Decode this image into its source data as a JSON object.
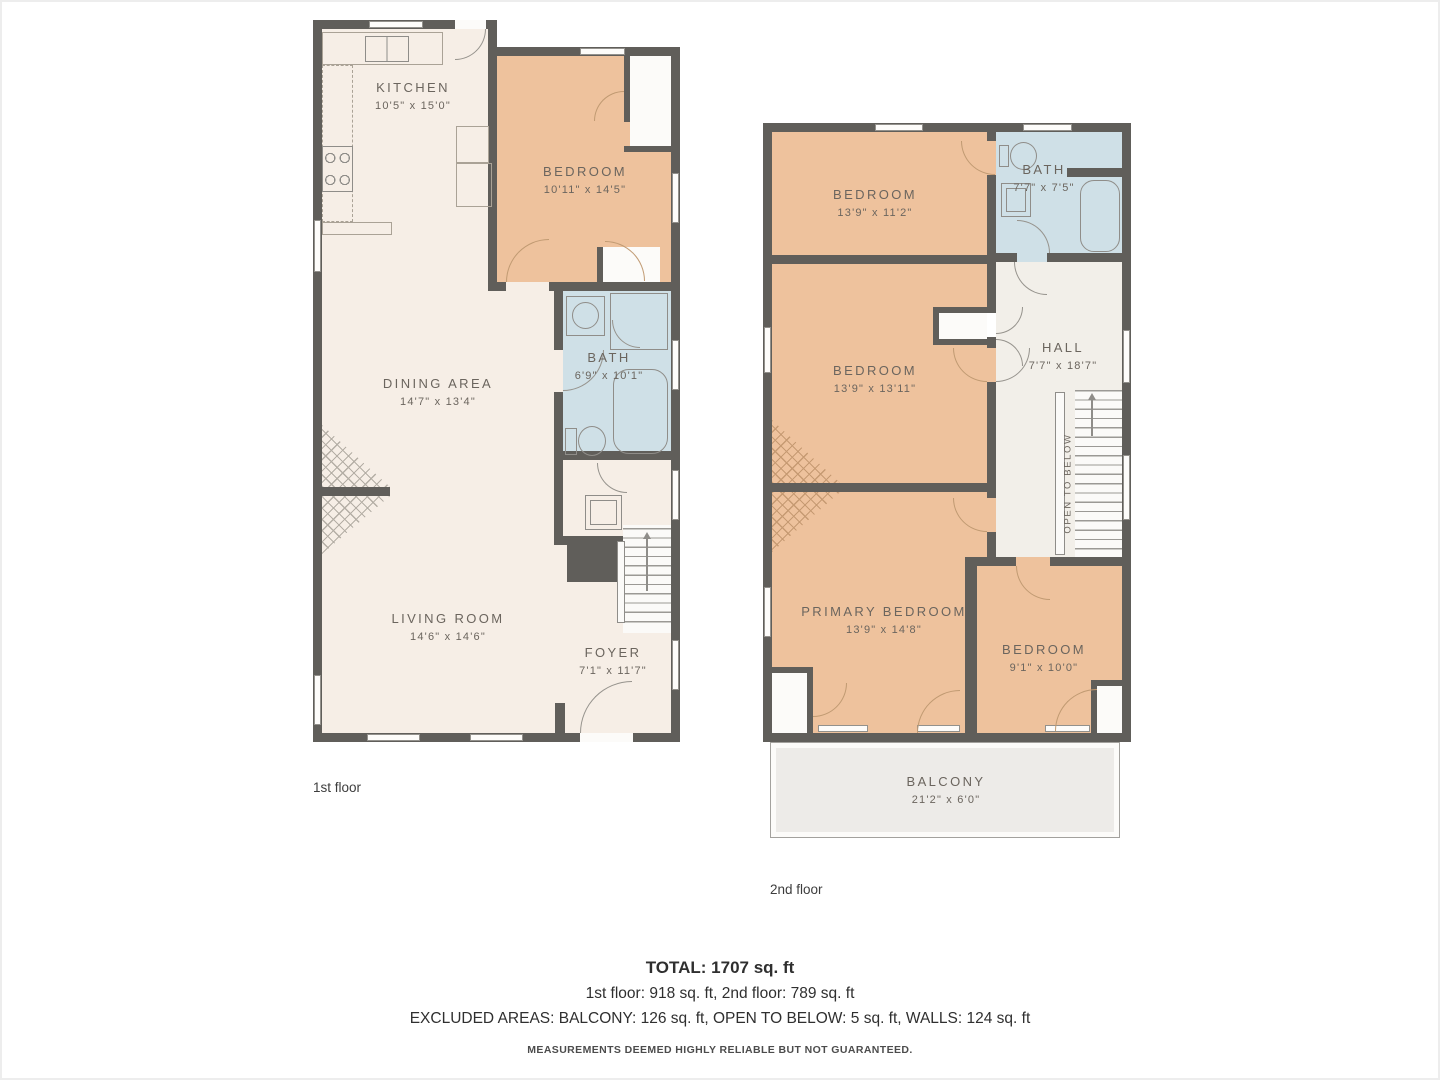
{
  "colors": {
    "wall": "#605e5a",
    "room_cream": "#f6eee6",
    "room_peach": "#eec29d",
    "bath_blue": "#cfe0e7",
    "hall_light": "#f2efe9",
    "balcony_gray": "#edebe8",
    "label_text": "#6b655e"
  },
  "floor1": {
    "caption": "1st floor",
    "kitchen": {
      "name": "KITCHEN",
      "dims": "10'5\" x 15'0\""
    },
    "bedroom": {
      "name": "BEDROOM",
      "dims": "10'11\" x 14'5\""
    },
    "bath": {
      "name": "BATH",
      "dims": "6'9\" x 10'1\""
    },
    "dining": {
      "name": "DINING AREA",
      "dims": "14'7\" x 13'4\""
    },
    "living": {
      "name": "LIVING ROOM",
      "dims": "14'6\" x 14'6\""
    },
    "foyer": {
      "name": "FOYER",
      "dims": "7'1\" x 11'7\""
    }
  },
  "floor2": {
    "caption": "2nd floor",
    "bedroom_top": {
      "name": "BEDROOM",
      "dims": "13'9\" x 11'2\""
    },
    "bath": {
      "name": "BATH",
      "dims": "7'7\" x 7'5\""
    },
    "bedroom_mid": {
      "name": "BEDROOM",
      "dims": "13'9\" x 13'11\""
    },
    "hall": {
      "name": "HALL",
      "dims": "7'7\" x 18'7\""
    },
    "primary_bedroom": {
      "name": "PRIMARY BEDROOM",
      "dims": "13'9\" x 14'8\""
    },
    "bedroom_small": {
      "name": "BEDROOM",
      "dims": "9'1\" x 10'0\""
    },
    "balcony": {
      "name": "BALCONY",
      "dims": "21'2\" x 6'0\""
    },
    "open_to_below": "OPEN TO BELOW"
  },
  "summary": {
    "total": "TOTAL: 1707 sq. ft",
    "floors": "1st floor: 918 sq. ft, 2nd floor: 789 sq. ft",
    "excluded": "EXCLUDED AREAS: BALCONY: 126 sq. ft, OPEN TO BELOW: 5 sq. ft, WALLS: 124 sq. ft",
    "disclaimer": "MEASUREMENTS DEEMED HIGHLY RELIABLE BUT NOT GUARANTEED."
  }
}
